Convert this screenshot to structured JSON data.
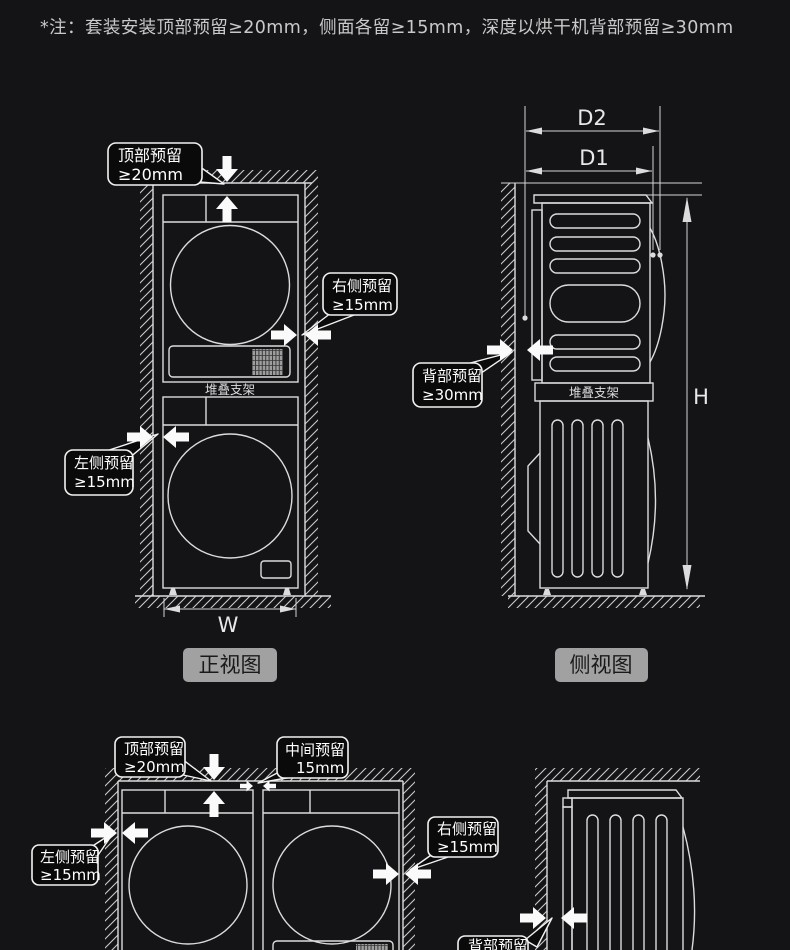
{
  "note": "*注：套装安装顶部预留≥20mm，侧面各留≥15mm，深度以烘干机背部预留≥30mm",
  "colors": {
    "background": "#141417",
    "line": "#dcdcdc",
    "callout_bg": "#0a0a0b",
    "callout_border": "#f2f2f2",
    "label_bg": "#a1a1a1",
    "label_text": "#1a1a1a",
    "arrow": "#fafafa"
  },
  "front_view": {
    "title": "正视图",
    "bracket_label": "堆叠支架",
    "width_label": "W",
    "callouts": {
      "top": {
        "line1": "顶部预留",
        "line2": "≥20mm"
      },
      "right": {
        "line1": "右侧预留",
        "line2": "≥15mm"
      },
      "left": {
        "line1": "左侧预留",
        "line2": "≥15mm"
      }
    }
  },
  "side_view": {
    "title": "侧视图",
    "bracket_label": "堆叠支架",
    "d2_label": "D2",
    "d1_label": "D1",
    "height_label": "H",
    "callouts": {
      "back": {
        "line1": "背部预留",
        "line2": "≥30mm"
      }
    }
  },
  "bottom_front_view": {
    "callouts": {
      "top": {
        "line1": "顶部预留",
        "line2": "≥20mm"
      },
      "middle": {
        "line1": "中间预留",
        "line2": "15mm"
      },
      "left": {
        "line1": "左侧预留",
        "line2": "≥15mm"
      },
      "right": {
        "line1": "右侧预留",
        "line2": "≥15mm"
      }
    }
  },
  "bottom_side_view": {
    "callouts": {
      "back": {
        "line1": "背部预留"
      }
    }
  }
}
